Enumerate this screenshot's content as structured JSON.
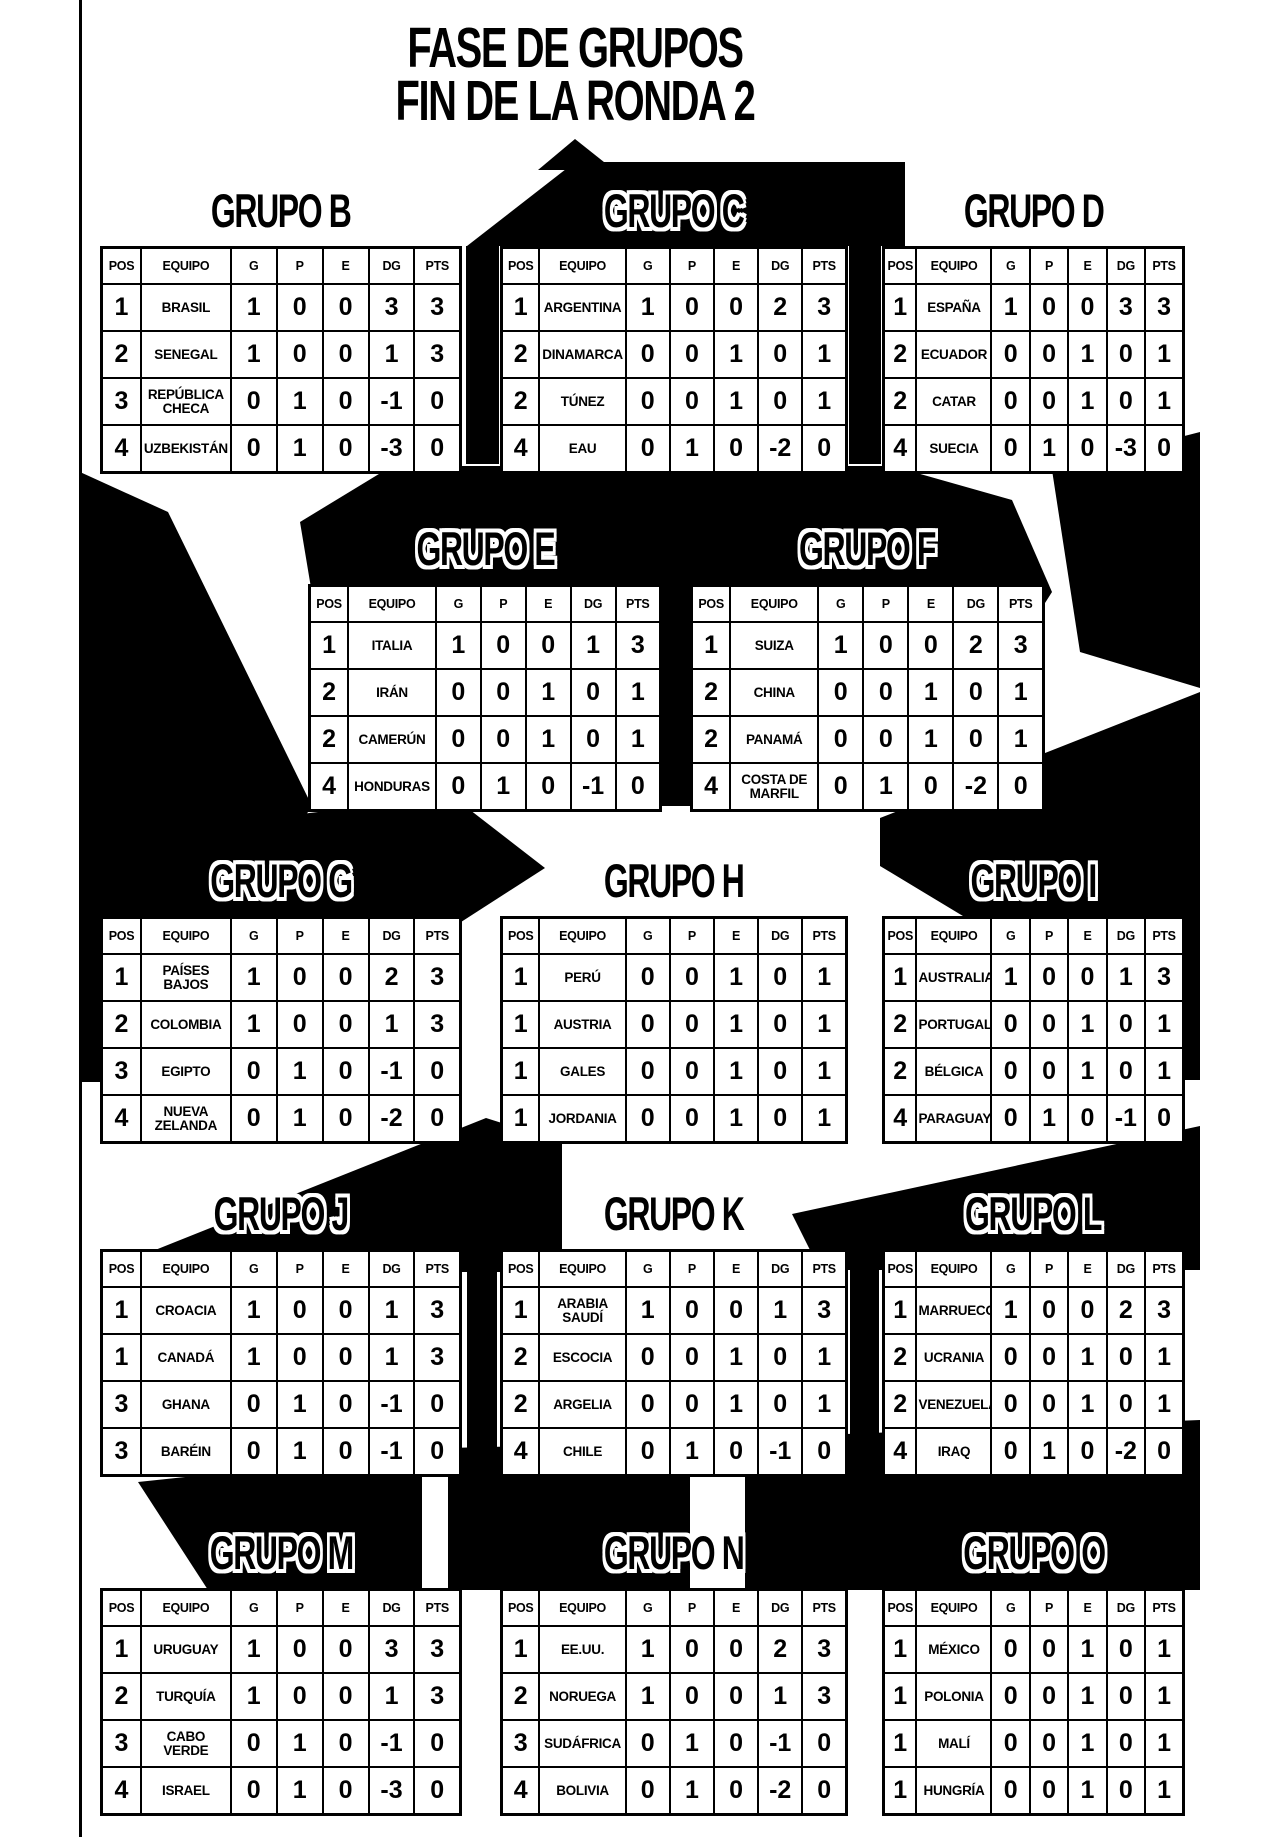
{
  "page_title": {
    "line1": "FASE DE GRUPOS",
    "line2": "FIN DE LA RONDA 2"
  },
  "table_columns": [
    "POS",
    "EQUIPO",
    "G",
    "P",
    "E",
    "DG",
    "PTS"
  ],
  "colors": {
    "ink": "#000000",
    "paper": "#ffffff"
  },
  "groups": [
    {
      "id": "b",
      "name": "GRUPO B",
      "title_outlined": false,
      "rows": [
        [
          "1",
          "BRASIL",
          "1",
          "0",
          "0",
          "3",
          "3"
        ],
        [
          "2",
          "SENEGAL",
          "1",
          "0",
          "0",
          "1",
          "3"
        ],
        [
          "3",
          "REPÚBLICA CHECA",
          "0",
          "1",
          "0",
          "-1",
          "0"
        ],
        [
          "4",
          "UZBEKISTÁN",
          "0",
          "1",
          "0",
          "-3",
          "0"
        ]
      ]
    },
    {
      "id": "c",
      "name": "GRUPO C",
      "title_outlined": true,
      "rows": [
        [
          "1",
          "ARGENTINA",
          "1",
          "0",
          "0",
          "2",
          "3"
        ],
        [
          "2",
          "DINAMARCA",
          "0",
          "0",
          "1",
          "0",
          "1"
        ],
        [
          "2",
          "TÚNEZ",
          "0",
          "0",
          "1",
          "0",
          "1"
        ],
        [
          "4",
          "EAU",
          "0",
          "1",
          "0",
          "-2",
          "0"
        ]
      ]
    },
    {
      "id": "d",
      "name": "GRUPO D",
      "title_outlined": false,
      "rows": [
        [
          "1",
          "ESPAÑA",
          "1",
          "0",
          "0",
          "3",
          "3"
        ],
        [
          "2",
          "ECUADOR",
          "0",
          "0",
          "1",
          "0",
          "1"
        ],
        [
          "2",
          "CATAR",
          "0",
          "0",
          "1",
          "0",
          "1"
        ],
        [
          "4",
          "SUECIA",
          "0",
          "1",
          "0",
          "-3",
          "0"
        ]
      ]
    },
    {
      "id": "e",
      "name": "GRUPO E",
      "title_outlined": true,
      "rows": [
        [
          "1",
          "ITALIA",
          "1",
          "0",
          "0",
          "1",
          "3"
        ],
        [
          "2",
          "IRÁN",
          "0",
          "0",
          "1",
          "0",
          "1"
        ],
        [
          "2",
          "CAMERÚN",
          "0",
          "0",
          "1",
          "0",
          "1"
        ],
        [
          "4",
          "HONDURAS",
          "0",
          "1",
          "0",
          "-1",
          "0"
        ]
      ]
    },
    {
      "id": "f",
      "name": "GRUPO F",
      "title_outlined": true,
      "rows": [
        [
          "1",
          "SUIZA",
          "1",
          "0",
          "0",
          "2",
          "3"
        ],
        [
          "2",
          "CHINA",
          "0",
          "0",
          "1",
          "0",
          "1"
        ],
        [
          "2",
          "PANAMÁ",
          "0",
          "0",
          "1",
          "0",
          "1"
        ],
        [
          "4",
          "COSTA DE MARFIL",
          "0",
          "1",
          "0",
          "-2",
          "0"
        ]
      ]
    },
    {
      "id": "g",
      "name": "GRUPO G",
      "title_outlined": true,
      "rows": [
        [
          "1",
          "PAÍSES BAJOS",
          "1",
          "0",
          "0",
          "2",
          "3"
        ],
        [
          "2",
          "COLOMBIA",
          "1",
          "0",
          "0",
          "1",
          "3"
        ],
        [
          "3",
          "EGIPTO",
          "0",
          "1",
          "0",
          "-1",
          "0"
        ],
        [
          "4",
          "NUEVA ZELANDA",
          "0",
          "1",
          "0",
          "-2",
          "0"
        ]
      ]
    },
    {
      "id": "h",
      "name": "GRUPO H",
      "title_outlined": false,
      "rows": [
        [
          "1",
          "PERÚ",
          "0",
          "0",
          "1",
          "0",
          "1"
        ],
        [
          "1",
          "AUSTRIA",
          "0",
          "0",
          "1",
          "0",
          "1"
        ],
        [
          "1",
          "GALES",
          "0",
          "0",
          "1",
          "0",
          "1"
        ],
        [
          "1",
          "JORDANIA",
          "0",
          "0",
          "1",
          "0",
          "1"
        ]
      ]
    },
    {
      "id": "i",
      "name": "GRUPO I",
      "title_outlined": true,
      "rows": [
        [
          "1",
          "AUSTRALIA",
          "1",
          "0",
          "0",
          "1",
          "3"
        ],
        [
          "2",
          "PORTUGAL",
          "0",
          "0",
          "1",
          "0",
          "1"
        ],
        [
          "2",
          "BÉLGICA",
          "0",
          "0",
          "1",
          "0",
          "1"
        ],
        [
          "4",
          "PARAGUAY",
          "0",
          "1",
          "0",
          "-1",
          "0"
        ]
      ]
    },
    {
      "id": "j",
      "name": "GRUPO J",
      "title_outlined": true,
      "rows": [
        [
          "1",
          "CROACIA",
          "1",
          "0",
          "0",
          "1",
          "3"
        ],
        [
          "1",
          "CANADÁ",
          "1",
          "0",
          "0",
          "1",
          "3"
        ],
        [
          "3",
          "GHANA",
          "0",
          "1",
          "0",
          "-1",
          "0"
        ],
        [
          "3",
          "BARÉIN",
          "0",
          "1",
          "0",
          "-1",
          "0"
        ]
      ]
    },
    {
      "id": "k",
      "name": "GRUPO K",
      "title_outlined": false,
      "rows": [
        [
          "1",
          "ARABIA SAUDÍ",
          "1",
          "0",
          "0",
          "1",
          "3"
        ],
        [
          "2",
          "ESCOCIA",
          "0",
          "0",
          "1",
          "0",
          "1"
        ],
        [
          "2",
          "ARGELIA",
          "0",
          "0",
          "1",
          "0",
          "1"
        ],
        [
          "4",
          "CHILE",
          "0",
          "1",
          "0",
          "-1",
          "0"
        ]
      ]
    },
    {
      "id": "l",
      "name": "GRUPO L",
      "title_outlined": true,
      "rows": [
        [
          "1",
          "MARRUECOS",
          "1",
          "0",
          "0",
          "2",
          "3"
        ],
        [
          "2",
          "UCRANIA",
          "0",
          "0",
          "1",
          "0",
          "1"
        ],
        [
          "2",
          "VENEZUELA",
          "0",
          "0",
          "1",
          "0",
          "1"
        ],
        [
          "4",
          "IRAQ",
          "0",
          "1",
          "0",
          "-2",
          "0"
        ]
      ]
    },
    {
      "id": "m",
      "name": "GRUPO M",
      "title_outlined": true,
      "rows": [
        [
          "1",
          "URUGUAY",
          "1",
          "0",
          "0",
          "3",
          "3"
        ],
        [
          "2",
          "TURQUÍA",
          "1",
          "0",
          "0",
          "1",
          "3"
        ],
        [
          "3",
          "CABO VERDE",
          "0",
          "1",
          "0",
          "-1",
          "0"
        ],
        [
          "4",
          "ISRAEL",
          "0",
          "1",
          "0",
          "-3",
          "0"
        ]
      ]
    },
    {
      "id": "n",
      "name": "GRUPO N",
      "title_outlined": true,
      "rows": [
        [
          "1",
          "EE.UU.",
          "1",
          "0",
          "0",
          "2",
          "3"
        ],
        [
          "2",
          "NORUEGA",
          "1",
          "0",
          "0",
          "1",
          "3"
        ],
        [
          "3",
          "SUDÁFRICA",
          "0",
          "1",
          "0",
          "-1",
          "0"
        ],
        [
          "4",
          "BOLIVIA",
          "0",
          "1",
          "0",
          "-2",
          "0"
        ]
      ]
    },
    {
      "id": "o",
      "name": "GRUPO O",
      "title_outlined": true,
      "rows": [
        [
          "1",
          "MÉXICO",
          "0",
          "0",
          "1",
          "0",
          "1"
        ],
        [
          "1",
          "POLONIA",
          "0",
          "0",
          "1",
          "0",
          "1"
        ],
        [
          "1",
          "MALÍ",
          "0",
          "0",
          "1",
          "0",
          "1"
        ],
        [
          "1",
          "HUNGRÍA",
          "0",
          "0",
          "1",
          "0",
          "1"
        ]
      ]
    }
  ]
}
